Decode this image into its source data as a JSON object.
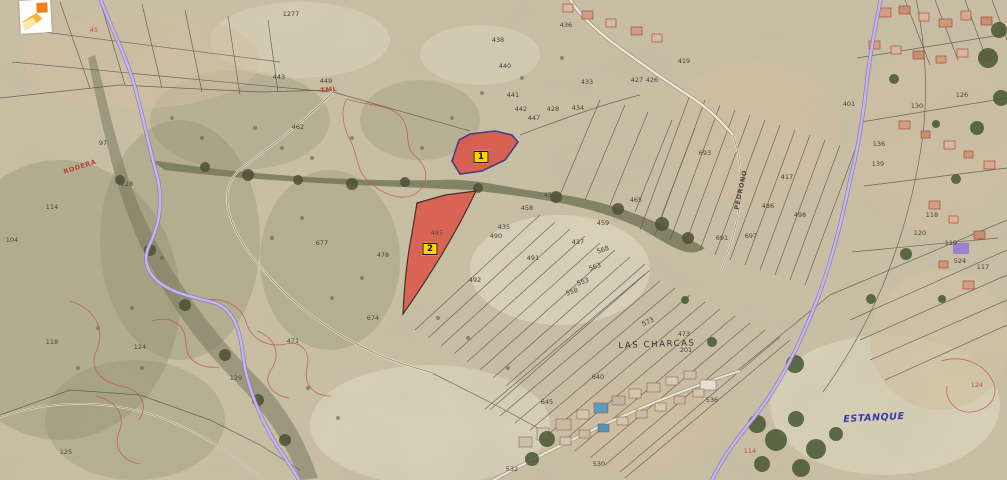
{
  "colors": {
    "terrain_base": "#cdc2a7",
    "highlight_fill": "#e2443a",
    "parcel1_stroke": "#3f3c80",
    "parcel2_stroke": "#3a2f23",
    "road_purple": "#c7b9ee",
    "road_purple_edge": "#8a76c6",
    "marker_bg": "#ffd200",
    "marker_border": "#1a1a1a",
    "number_dark": "#3c3a31",
    "number_red": "#bc4338",
    "estanque_blue": "#3b35b5",
    "boundary_line": "#57534a",
    "contour_red": "#c4544a",
    "logo_orange": "#f08019",
    "logo_amber": "#f5b33c",
    "logo_pale": "#fae9a8"
  },
  "map": {
    "selected_parcels": [
      {
        "id": "1",
        "marker": "1",
        "x": 481,
        "y": 157
      },
      {
        "id": "2",
        "marker": "2",
        "x": 430,
        "y": 249
      }
    ],
    "place_labels": [
      {
        "t": "LAS CHARCAS",
        "x": 657,
        "y": 345,
        "cls": "place",
        "r": -2
      },
      {
        "t": "ESTANQUE",
        "x": 874,
        "y": 418,
        "cls": "water",
        "r": -3
      }
    ],
    "road_labels": [
      {
        "t": "TML",
        "x": 329,
        "y": 90,
        "r": -5
      },
      {
        "t": "RODERA",
        "x": 80,
        "y": 167,
        "r": -18
      },
      {
        "t": "PEDRONO",
        "x": 741,
        "y": 190,
        "r": -78,
        "c": "dark"
      }
    ],
    "parcel_numbers": [
      {
        "t": "1277",
        "x": 291,
        "y": 14
      },
      {
        "t": "443",
        "x": 279,
        "y": 77
      },
      {
        "t": "449",
        "x": 326,
        "y": 81
      },
      {
        "t": "462",
        "x": 298,
        "y": 127
      },
      {
        "t": "438",
        "x": 498,
        "y": 40
      },
      {
        "t": "436",
        "x": 566,
        "y": 25
      },
      {
        "t": "440",
        "x": 505,
        "y": 66
      },
      {
        "t": "441",
        "x": 513,
        "y": 95
      },
      {
        "t": "442",
        "x": 521,
        "y": 109
      },
      {
        "t": "447",
        "x": 534,
        "y": 118
      },
      {
        "t": "434",
        "x": 578,
        "y": 108
      },
      {
        "t": "433",
        "x": 587,
        "y": 82
      },
      {
        "t": "428",
        "x": 553,
        "y": 109
      },
      {
        "t": "427",
        "x": 637,
        "y": 80
      },
      {
        "t": "426",
        "x": 652,
        "y": 80
      },
      {
        "t": "419",
        "x": 684,
        "y": 61
      },
      {
        "t": "417",
        "x": 787,
        "y": 177
      },
      {
        "t": "486",
        "x": 768,
        "y": 206
      },
      {
        "t": "498",
        "x": 800,
        "y": 215
      },
      {
        "t": "693",
        "x": 705,
        "y": 153
      },
      {
        "t": "691",
        "x": 722,
        "y": 238
      },
      {
        "t": "697",
        "x": 751,
        "y": 236
      },
      {
        "t": "456",
        "x": 550,
        "y": 195
      },
      {
        "t": "458",
        "x": 527,
        "y": 208
      },
      {
        "t": "435",
        "x": 504,
        "y": 227
      },
      {
        "t": "490",
        "x": 496,
        "y": 236
      },
      {
        "t": "437",
        "x": 578,
        "y": 242
      },
      {
        "t": "459",
        "x": 603,
        "y": 223
      },
      {
        "t": "491",
        "x": 533,
        "y": 258
      },
      {
        "t": "568",
        "x": 603,
        "y": 250,
        "r": -20
      },
      {
        "t": "563",
        "x": 595,
        "y": 267,
        "r": -20
      },
      {
        "t": "558",
        "x": 572,
        "y": 292,
        "r": -20
      },
      {
        "t": "553",
        "x": 583,
        "y": 282,
        "r": -20
      },
      {
        "t": "465",
        "x": 636,
        "y": 200
      },
      {
        "t": "492",
        "x": 475,
        "y": 280
      },
      {
        "t": "485",
        "x": 437,
        "y": 233,
        "c": "inhl"
      },
      {
        "t": "674",
        "x": 373,
        "y": 318
      },
      {
        "t": "471",
        "x": 293,
        "y": 341
      },
      {
        "t": "677",
        "x": 322,
        "y": 243
      },
      {
        "t": "478",
        "x": 383,
        "y": 255
      },
      {
        "t": "128",
        "x": 127,
        "y": 184
      },
      {
        "t": "114",
        "x": 52,
        "y": 207
      },
      {
        "t": "97",
        "x": 103,
        "y": 143
      },
      {
        "t": "118",
        "x": 52,
        "y": 342
      },
      {
        "t": "124",
        "x": 140,
        "y": 347
      },
      {
        "t": "129",
        "x": 236,
        "y": 378
      },
      {
        "t": "104",
        "x": 12,
        "y": 240
      },
      {
        "t": "125",
        "x": 66,
        "y": 452
      },
      {
        "t": "201",
        "x": 686,
        "y": 350
      },
      {
        "t": "473",
        "x": 684,
        "y": 334
      },
      {
        "t": "573",
        "x": 648,
        "y": 322,
        "r": -25
      },
      {
        "t": "640",
        "x": 598,
        "y": 377
      },
      {
        "t": "645",
        "x": 547,
        "y": 402
      },
      {
        "t": "536",
        "x": 712,
        "y": 400
      },
      {
        "t": "530",
        "x": 599,
        "y": 464
      },
      {
        "t": "532",
        "x": 512,
        "y": 469
      },
      {
        "t": "533",
        "x": 533,
        "y": 461
      },
      {
        "t": "401",
        "x": 849,
        "y": 104
      },
      {
        "t": "130",
        "x": 917,
        "y": 106
      },
      {
        "t": "136",
        "x": 879,
        "y": 144
      },
      {
        "t": "139",
        "x": 878,
        "y": 164
      },
      {
        "t": "126",
        "x": 962,
        "y": 95
      },
      {
        "t": "118",
        "x": 932,
        "y": 215
      },
      {
        "t": "120",
        "x": 920,
        "y": 233
      },
      {
        "t": "119",
        "x": 951,
        "y": 243
      },
      {
        "t": "524",
        "x": 960,
        "y": 261
      },
      {
        "t": "117",
        "x": 983,
        "y": 267
      },
      {
        "t": "114",
        "x": 750,
        "y": 451,
        "c": "red"
      },
      {
        "t": "124",
        "x": 977,
        "y": 385,
        "c": "red"
      },
      {
        "t": "45",
        "x": 94,
        "y": 30,
        "c": "red"
      }
    ]
  }
}
